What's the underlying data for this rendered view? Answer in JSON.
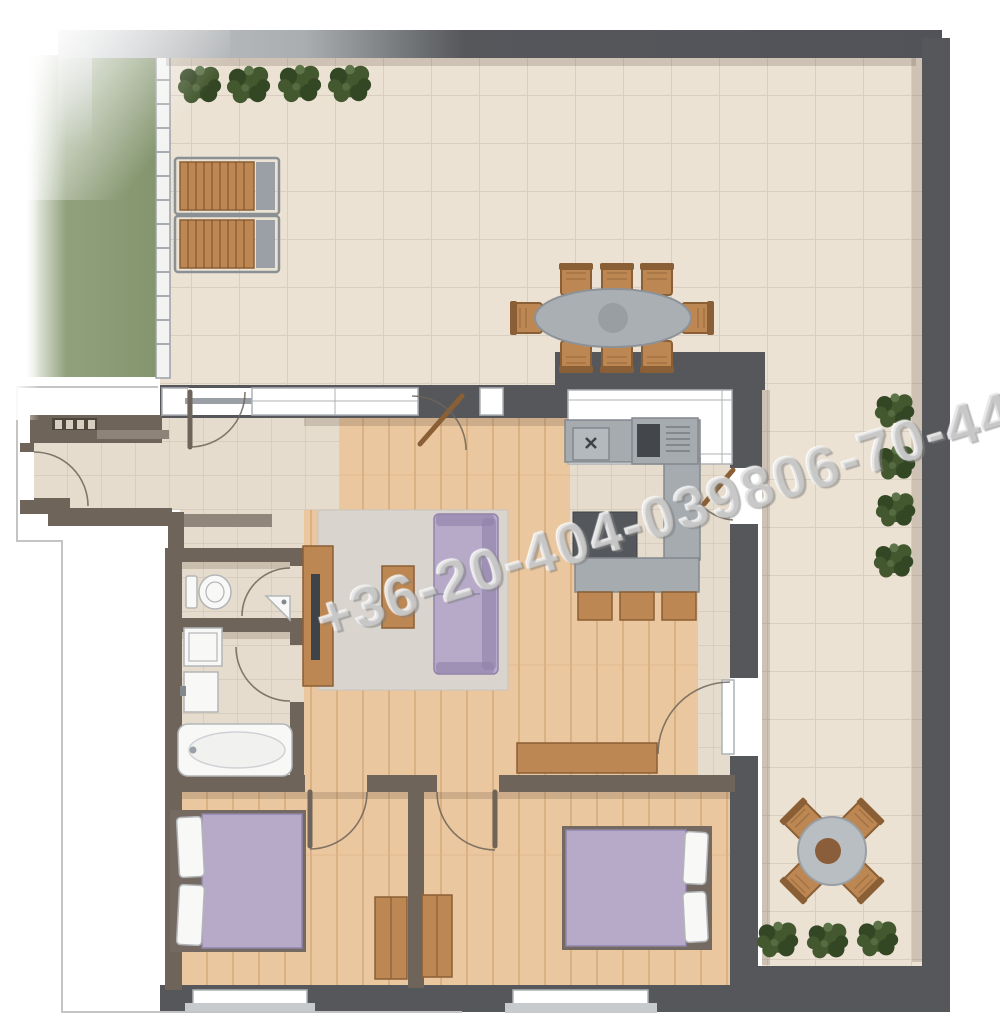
{
  "title": "apartment-floor-plan-top-view",
  "watermark": {
    "text": "+36-20-404-039806-70-442-2"
  },
  "palette": {
    "bg": "#ffffff",
    "wall-dark": "#55575b",
    "wall-light": "#c9cbcd",
    "wall-interior": "#6e6459",
    "wall-step": "#90867b",
    "frame": "#aeb2b6",
    "terrace-tile": "#ebe2d4",
    "terrace-grout": "#d9cfc0",
    "hall-tile": "#e6dccd",
    "hall-grout": "#d5c9ba",
    "wood": "#eac79e",
    "wood-line": "#dab183",
    "grass": "#91a17c",
    "grass-dark": "#84956e",
    "railing": "#f3f3f2",
    "rug": "#d9d5ce",
    "sofa": "#b7aac9",
    "sofa-dark": "#9084ab",
    "furn-wood": "#bd8753",
    "furn-wood-dark": "#8a5f35",
    "counter": "#a6abb0",
    "counter-dark": "#54575c",
    "fixture": "#f8f8f7",
    "fixture-edge": "#b2b5b8",
    "plant": "#44582f",
    "plant-dark": "#344724",
    "plant-light": "#5c7448",
    "shadow": "rgba(88,72,56,0.20)",
    "watermark": "rgba(214,214,214,0.55)"
  },
  "objects": {
    "outdoor": [
      "grass-strip",
      "glass-railing",
      "terrace",
      "shrubs",
      "sun-loungers",
      "outdoor-dining-table",
      "bistro-set"
    ],
    "rooms": [
      "entrance-hall",
      "living-room",
      "kitchen",
      "wc",
      "bathroom",
      "bedroom-1",
      "bedroom-2"
    ],
    "furniture": [
      "sofa",
      "coffee-table",
      "tv-cabinet",
      "rug",
      "sideboard",
      "kitchen-counter",
      "stove",
      "sink",
      "island",
      "bench",
      "bar-stools",
      "bathtub",
      "washing-machine",
      "toilet",
      "double-bed",
      "wardrobe"
    ]
  }
}
